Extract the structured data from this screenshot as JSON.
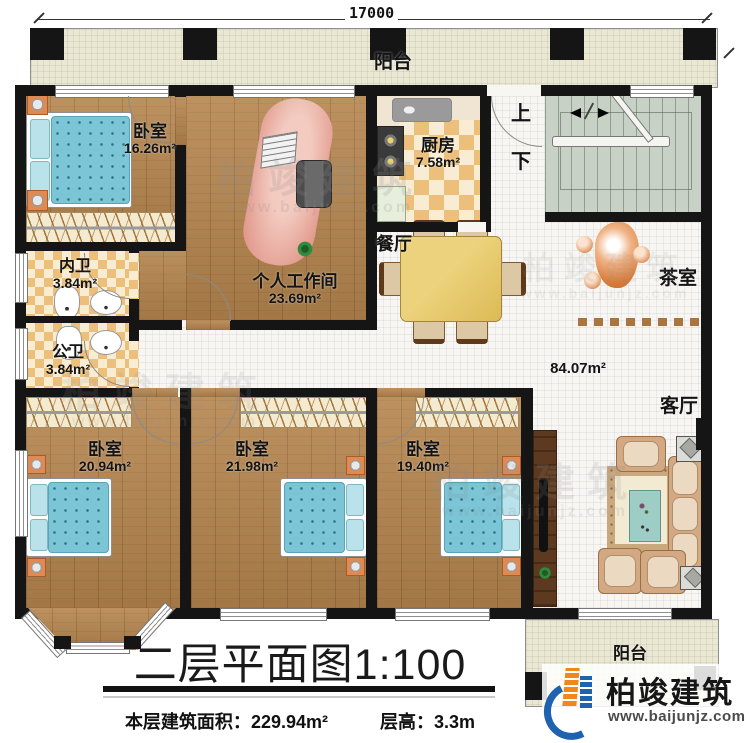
{
  "dimensions": {
    "top": "17000",
    "right": "16180"
  },
  "rooms": {
    "balcony_top": {
      "label": "阳台"
    },
    "balcony_bottom": {
      "label": "阳台"
    },
    "bedroom_top": {
      "label": "卧室",
      "area": "16.26m²"
    },
    "kitchen": {
      "label": "厨房",
      "area": "7.58m²"
    },
    "stairs": {
      "up": "上",
      "down": "下"
    },
    "inner_bath": {
      "label": "内卫",
      "area": "3.84m²"
    },
    "public_bath": {
      "label": "公卫",
      "area": "3.84m²"
    },
    "workspace": {
      "label": "个人工作间",
      "area": "23.69m²"
    },
    "dining": {
      "label": "餐厅"
    },
    "tea_room": {
      "label": "茶室"
    },
    "living_room": {
      "label": "客厅"
    },
    "hall": {
      "area": "84.07m²"
    },
    "bedroom_left": {
      "label": "卧室",
      "area": "20.94m²"
    },
    "bedroom_mid": {
      "label": "卧室",
      "area": "21.98m²"
    },
    "bedroom_right": {
      "label": "卧室",
      "area": "19.40m²"
    }
  },
  "title_block": {
    "title": "二层平面图1:100",
    "area_label": "本层建筑面积：",
    "area_value": "229.94m²",
    "height_label": "层高：",
    "height_value": "3.3m"
  },
  "branding": {
    "name": "柏竣建筑",
    "website": "www.baijunjz.com"
  },
  "watermark": {
    "name": "柏竣建筑",
    "website": "www.baijunjz.com"
  },
  "colors": {
    "wall": "#151515",
    "wood_floor": "#b5854e",
    "tile_floor": "#f7f6f3",
    "balcony_floor": "#eae7d2",
    "kitchen_checker": "#ecbf7a",
    "stair_floor": "#c8d1c5",
    "bed_mattress": "#7cc5d6",
    "nightstand": "#e08a52",
    "dining_table": "#e2c162",
    "sofa": "#d3a983",
    "sculpture": "#d97f3e",
    "logo_blue": "#1e62b0",
    "logo_orange": "#f0861c"
  }
}
